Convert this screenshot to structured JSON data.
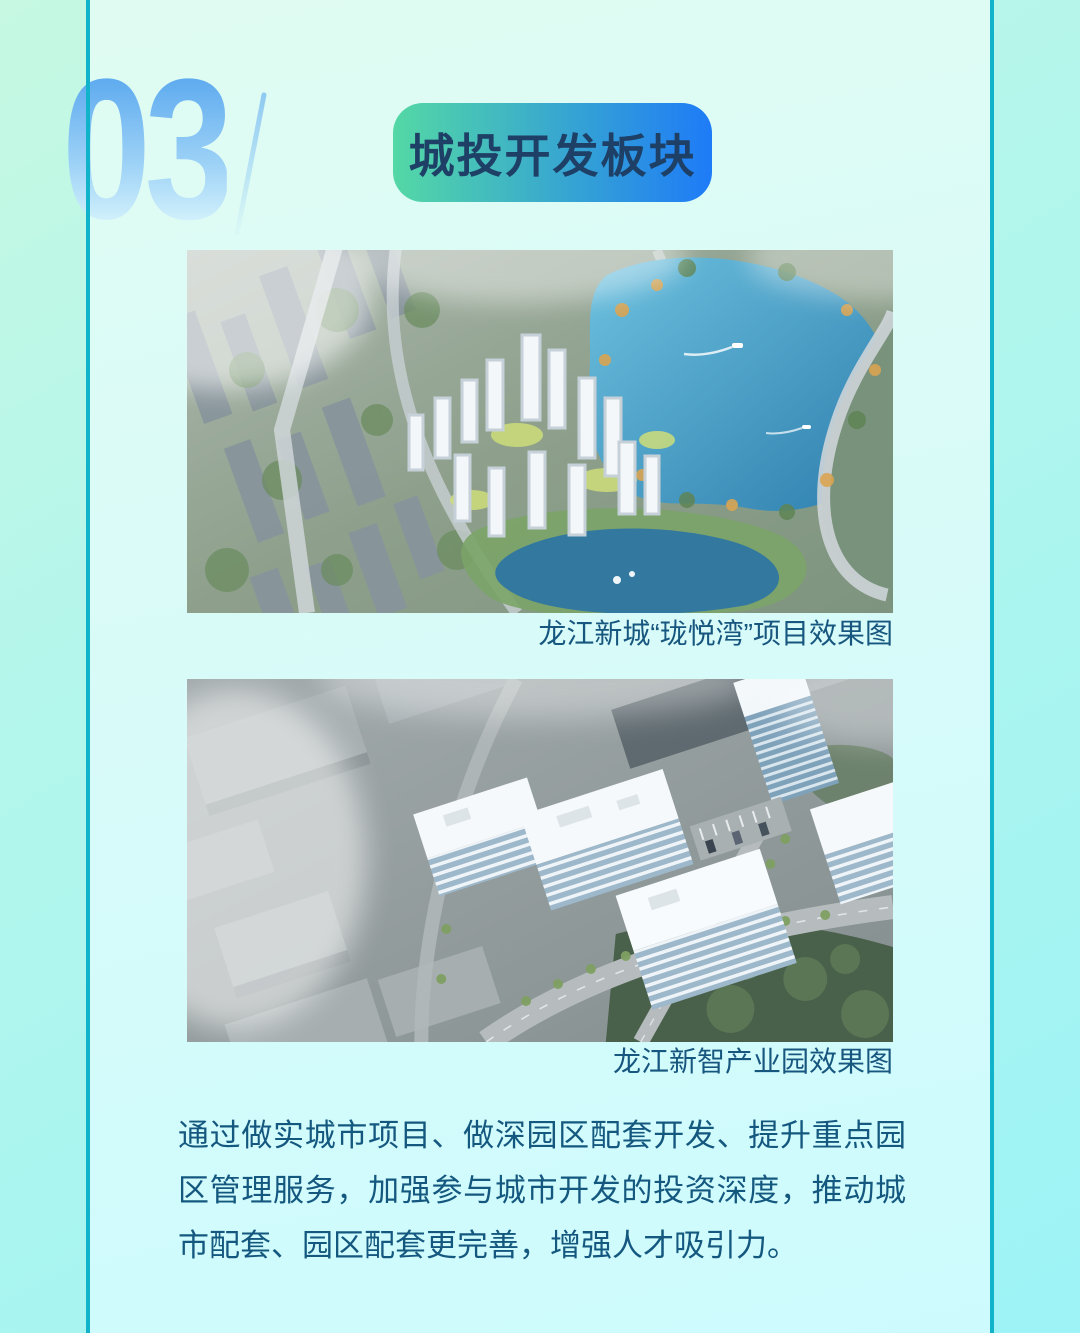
{
  "theme": {
    "accent-line": "#10b3c9",
    "badge-start": "#54d8a5",
    "badge-end": "#1e7bf7",
    "badge-text": "#1e4066",
    "caption-text": "#17567e",
    "body-text": "#14587f",
    "number-blue": "#55a5ee"
  },
  "header": {
    "section_number": "03",
    "badge_label": "城投开发板块"
  },
  "figures": [
    {
      "caption": "龙江新城“珑悦湾”项目效果图"
    },
    {
      "caption": "龙江新智产业园效果图"
    }
  ],
  "body": {
    "paragraph": "通过做实城市项目、做深园区配套开发、提升重点园区管理服务，加强参与城市开发的投资深度，推动城市配套、园区配套更完善，增强人才吸引力。"
  }
}
